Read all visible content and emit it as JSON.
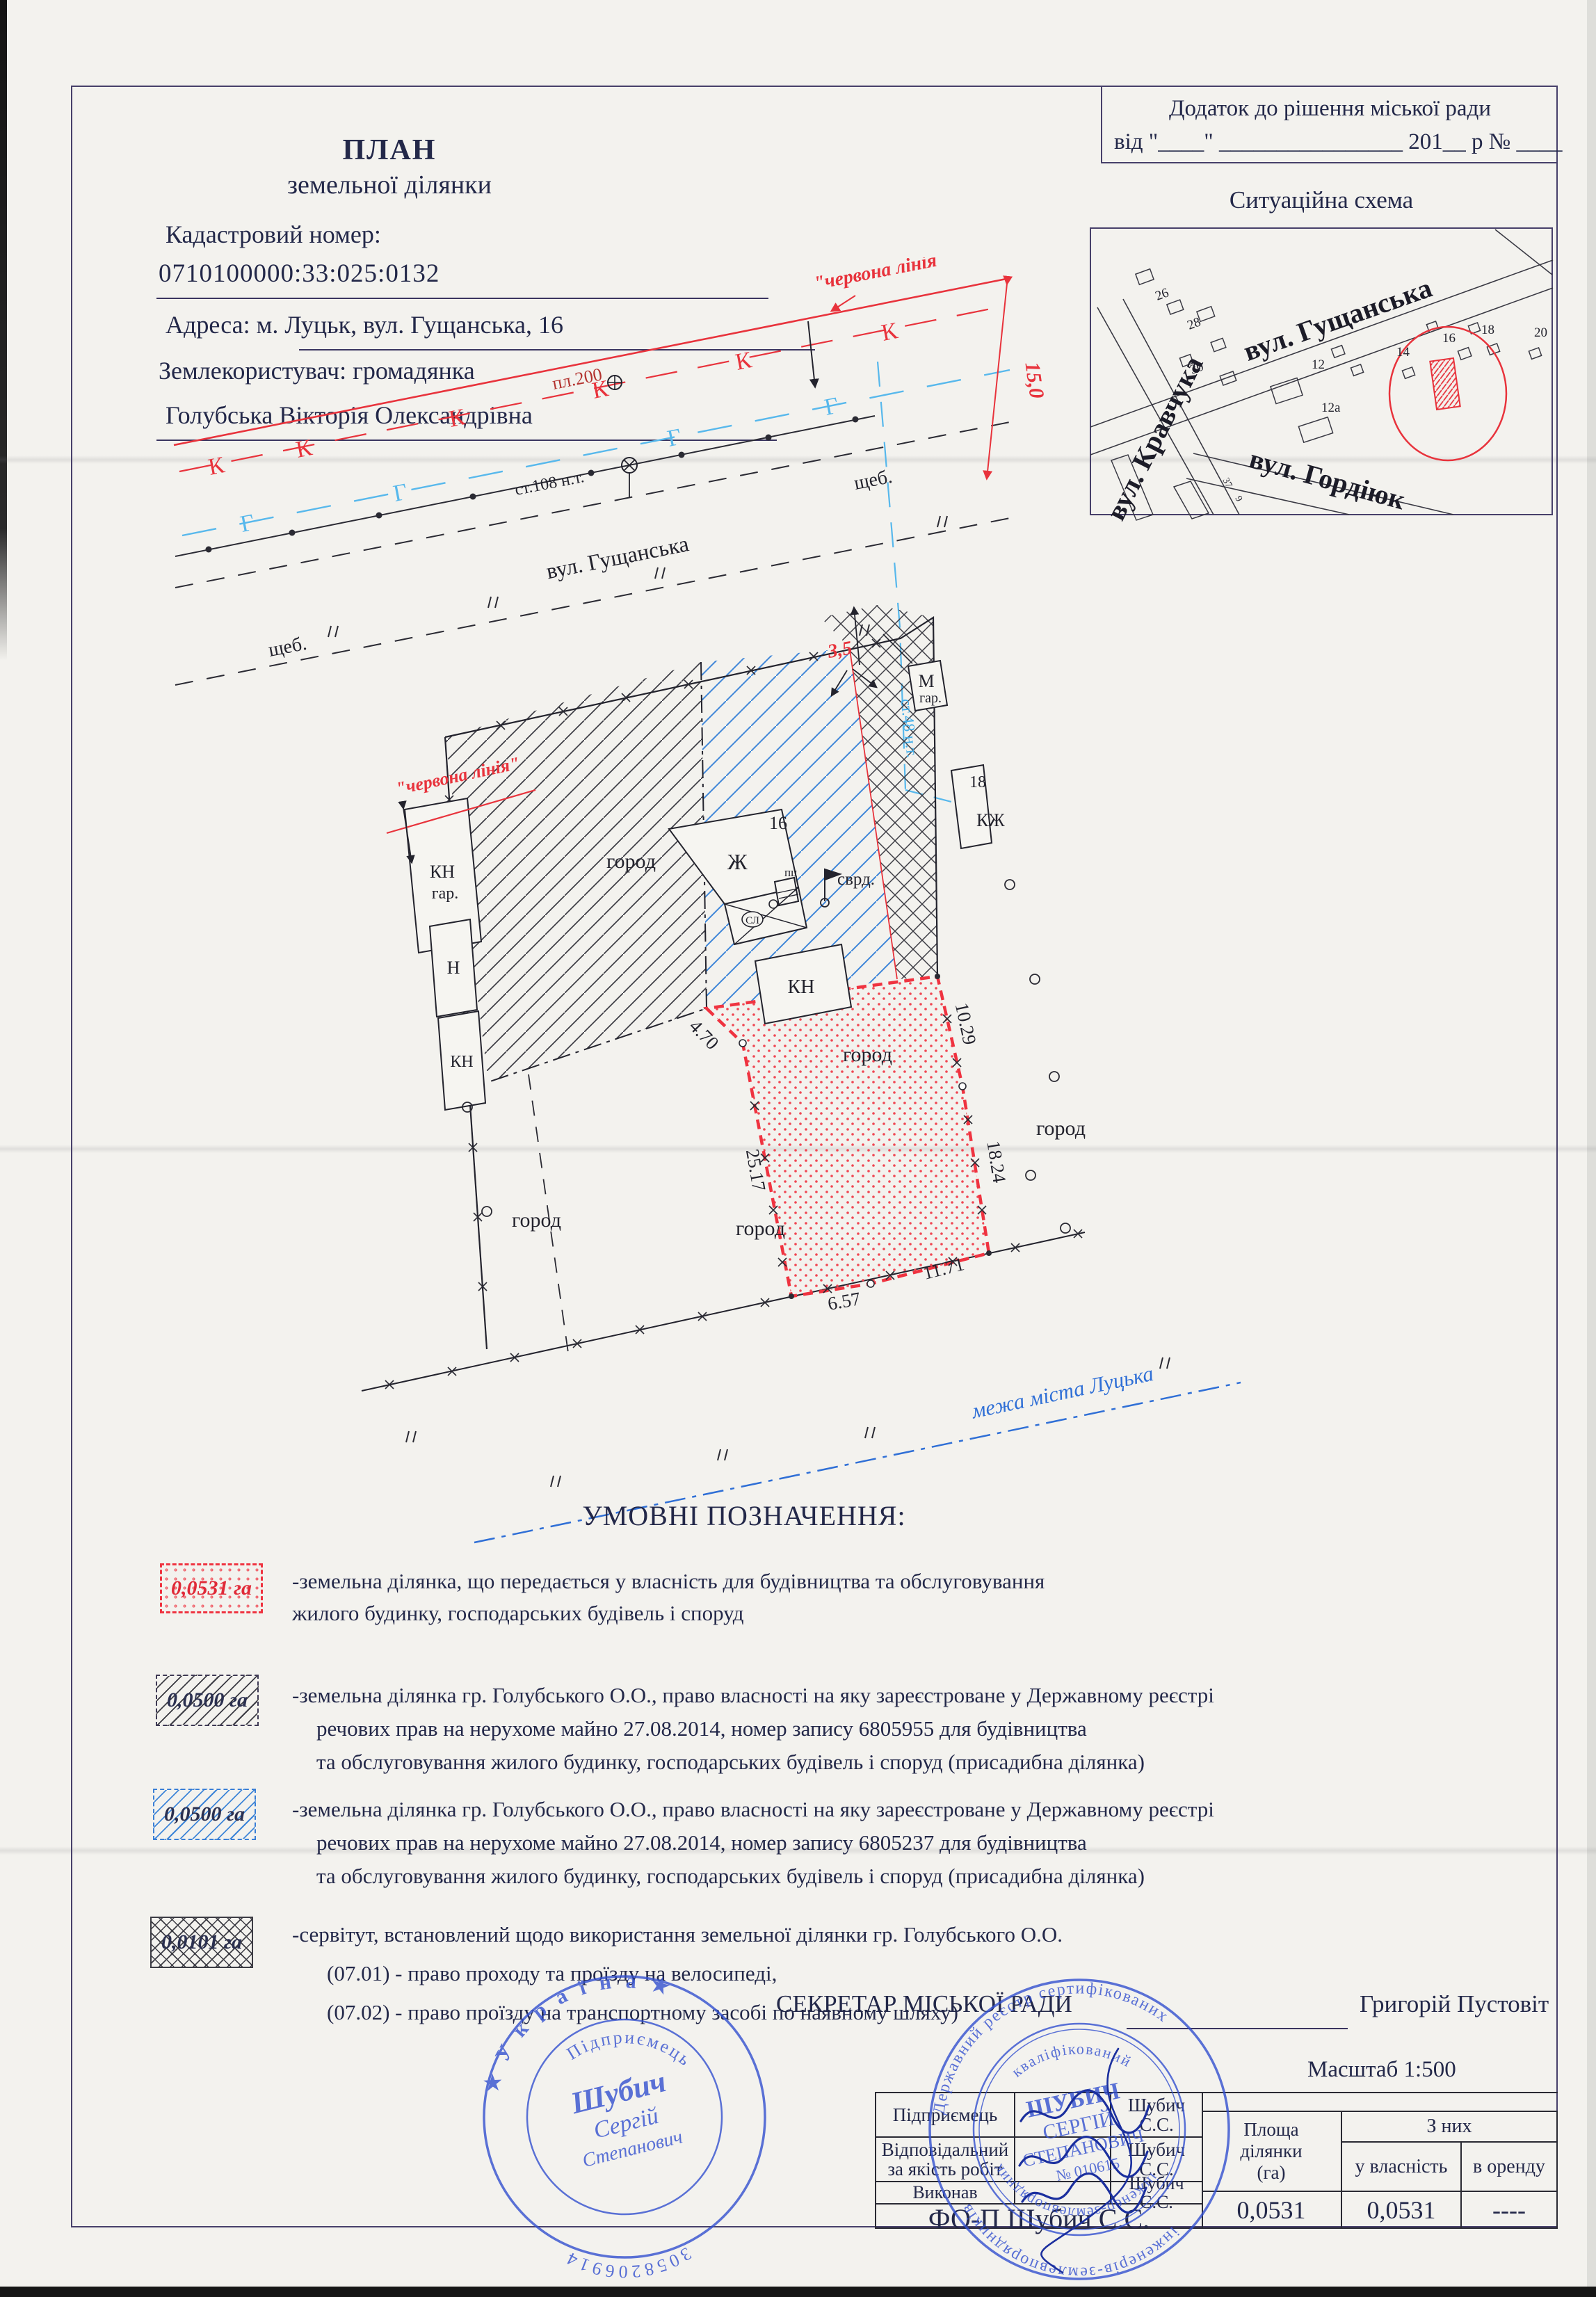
{
  "colors": {
    "red": "#e8333c",
    "legend_red": "#ef3340",
    "blue_hatch": "#3f86d8",
    "gas_blue": "#57b8ec",
    "stamp_blue": "#3350cf",
    "city_border_blue": "#2f6fd6",
    "ink": "#232849"
  },
  "header": {
    "title_line1": "ПЛАН",
    "title_line2": "земельної ділянки",
    "cadastral_label": "Кадастровий номер:",
    "cadastral_number": "0710100000:33:025:0132",
    "address": "Адреса: м. Луцьк, вул. Гущанська,  16",
    "landuser_line1": "Землекористувач: громадянка",
    "landuser_line2": "Голубська Вікторія Олександрівна"
  },
  "annex": {
    "line1": "Додаток до рішення міської ради",
    "line2": "від \"____\" ________________ 201__ р № ____"
  },
  "scheme": {
    "title": "Ситуаційна схема",
    "street_gushchanska": "вул. Гущанська",
    "street_kravchuka": "вул. Кравчука",
    "street_gordiuk": "вул. Гордіюк",
    "n26": "26",
    "n28": "28",
    "n30": "30",
    "n12": "12",
    "n12a": "12а",
    "n14": "14",
    "n16": "16",
    "n18": "18",
    "n20": "20",
    "n37": "37",
    "n9": "9"
  },
  "plan": {
    "street_name": "вул. Гущанська",
    "red_line_label": "\"червона лінія\"",
    "k": "К",
    "g": "Г",
    "pl200": "пл.200",
    "st108": "ст.108 н.т.",
    "st48": "ст.48 н.т.",
    "shcheb": "щеб.",
    "dim15": "15,0",
    "dim35": "3,5",
    "d470": "4.70",
    "d2517": "25.17",
    "d657": "6.57",
    "d1171": "11.71",
    "d1029": "10.29",
    "d1824": "18.24",
    "gorod": "город",
    "svrd": "сврд.",
    "city_border": "межа міста Луцька",
    "b_kn": "КН",
    "b_gar": "гар.",
    "b_n": "Н",
    "b_zh": "Ж",
    "b_16": "16",
    "b_pc": "пц",
    "b_sl": "СЛ",
    "b_m": "М",
    "b_18": "18",
    "b_kzh": "КЖ"
  },
  "legend": {
    "title": "УМОВНІ ПОЗНАЧЕННЯ:",
    "items": [
      {
        "area": "0,0531 га",
        "lines": [
          "-земельна ділянка, що передається у власність для будівництва та обслуговування",
          "жилого будинку, господарських будівель і споруд"
        ]
      },
      {
        "area": "0,0500 га",
        "lines": [
          "-земельна ділянка гр. Голубського О.О., право власності на яку зареєстроване у Державному реєстрі",
          "речових прав на нерухоме майно 27.08.2014, номер запису 6805955  для будівництва",
          "та обслуговування жилого будинку, господарських будівель і споруд (присадибна ділянка)"
        ]
      },
      {
        "area": "0,0500 га",
        "lines": [
          "-земельна ділянка гр. Голубського О.О., право власності на яку зареєстроване у Державному реєстрі",
          "речових прав на нерухоме майно 27.08.2014, номер запису 6805237  для будівництва",
          "та обслуговування жилого будинку, господарських будівель і споруд (присадибна ділянка)"
        ]
      },
      {
        "area": "0,0101 га",
        "lines": [
          "-сервітут, встановлений щодо використання земельної ділянки гр. Голубського О.О.",
          "(07.01) - право проходу та проїзду на велосипеді,",
          "(07.02) - право проїзду на транспортному засобі по наявному шляху)"
        ]
      }
    ]
  },
  "signoff": {
    "secretary_label": "СЕКРЕТАР МІСЬКОЇ РАДИ",
    "secretary_name": "Григорій Пустовіт",
    "scale": "Масштаб 1:500",
    "rows": [
      {
        "role": "Підприємець",
        "name": "Шубич С.С."
      },
      {
        "role": "Відповідальний за якість робіт",
        "name": "Шубич С.С."
      },
      {
        "role": "Виконав",
        "name": "Шубич С.С."
      }
    ],
    "footer": "ФО-П Шубич С.С.",
    "area_table": {
      "c1a": "Площа",
      "c1b": "ділянки",
      "c1c": "(га)",
      "group": "З них",
      "own": "у власність",
      "rent": "в оренду",
      "area_val": "0,0531",
      "own_val": "0,0531",
      "rent_val": "----"
    },
    "stamp1": {
      "ring_top": "★ У к р а ї н а ★",
      "ring_bottom": "3058206914",
      "arc": "Підприємець",
      "name1": "Шубич",
      "name2": "Сергій",
      "name3": "Степанович"
    },
    "stamp2": {
      "ring_top": "Державний реєстр сертифікованих",
      "ring_bottom": "інженерів-землевпорядників",
      "arc_top": "кваліфікований",
      "arc_bottom": "інженер-землевпорядник",
      "name1": "ШУБИЧ",
      "name2": "СЕРГІЙ",
      "name3": "СТЕПАНОВИЧ",
      "number": "№ 010615"
    }
  }
}
